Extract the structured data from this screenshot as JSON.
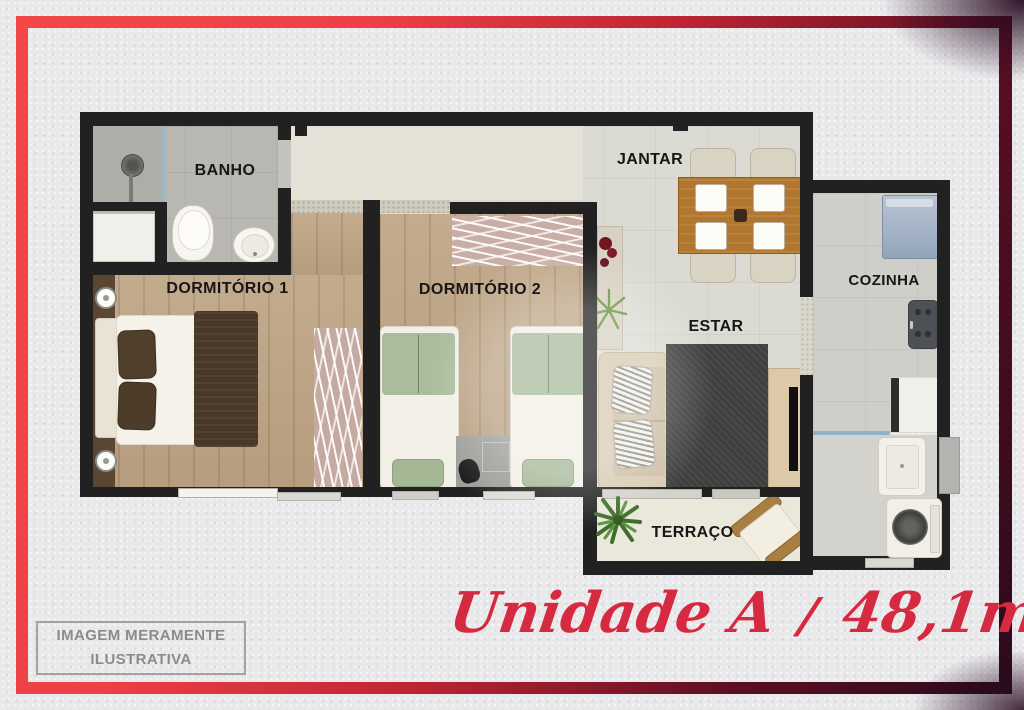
{
  "rooms": {
    "banho": "BANHO",
    "dormitorio1": "DORMITÓRIO 1",
    "dormitorio2": "DORMITÓRIO 2",
    "jantar": "JANTAR",
    "estar": "ESTAR",
    "cozinha": "COZINHA",
    "terraco": "TERRAÇO"
  },
  "disclaimer": {
    "line1": "IMAGEM MERAMENTE",
    "line2": "ILUSTRATIVA"
  },
  "footer": {
    "unit": "Unidade A",
    "separator": "/",
    "area": "48,1m",
    "exponent": "2"
  },
  "colors": {
    "border_red": "#f24848",
    "border_dark": "#2b0a1c",
    "title_red": "#d62a40",
    "wall": "#212121",
    "wood_floor": "#bfa585",
    "tile_floor": "#dcdbd3"
  }
}
